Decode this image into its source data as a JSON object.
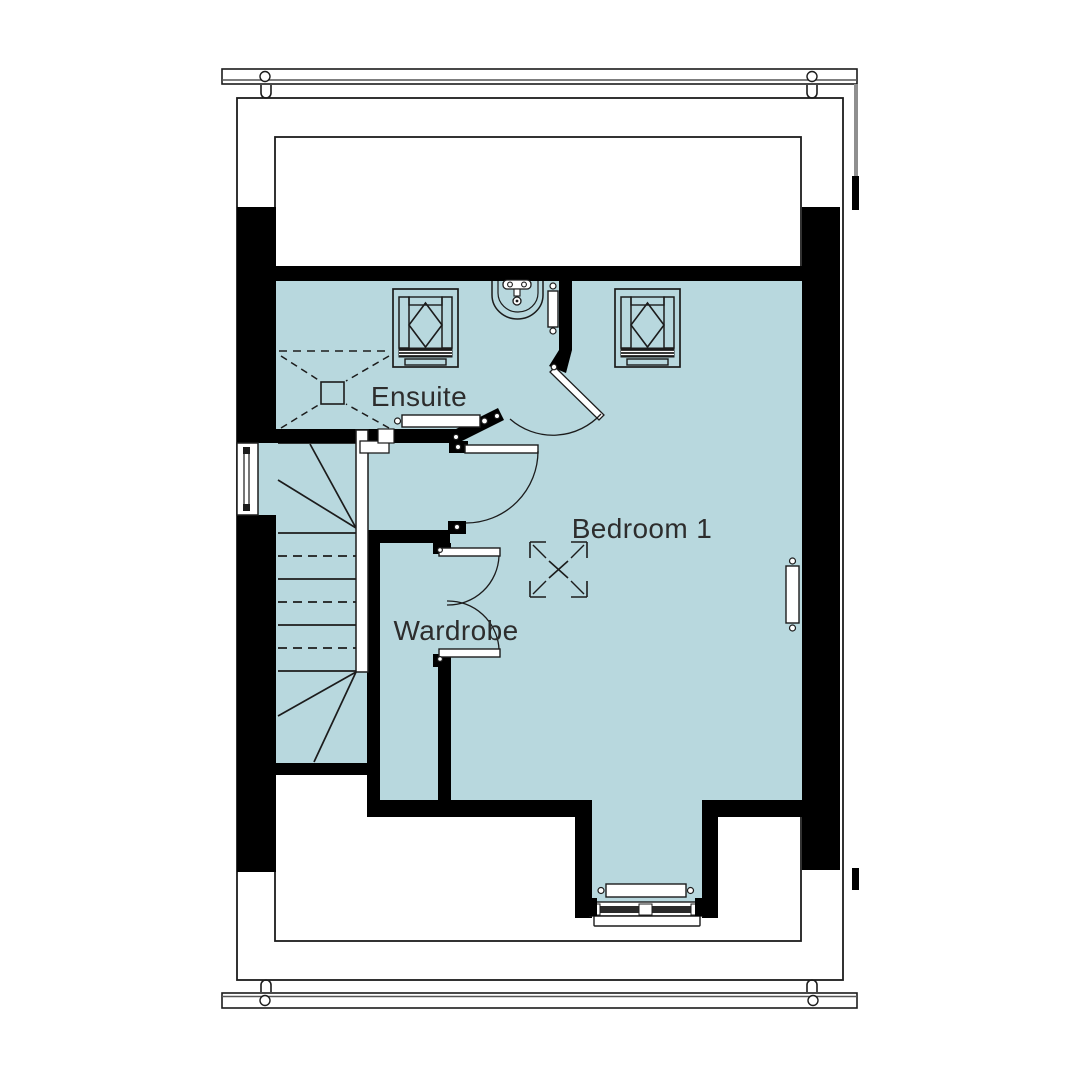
{
  "drawing": {
    "type": "architectural-floor-plan",
    "labels": {
      "ensuite": "Ensuite",
      "bedroom": "Bedroom 1",
      "wardrobe": "Wardrobe"
    },
    "colors": {
      "floor": "#b8d8de",
      "wall": "#000000",
      "line": "#1c1c1c",
      "label_text": "#2d2d2d",
      "gutter_line": "#555555",
      "downpipe": "#8f8f8f"
    },
    "fixtures": [
      "stairs-with-winders",
      "rooflight-ensuite",
      "rooflight-bedroom",
      "wash-basin",
      "shower-extract-symbol",
      "ceiling-hatch-symbol",
      "towel-radiator-ensuite",
      "radiator-ensuite-south",
      "radiator-bedroom-east",
      "radiator-dormer",
      "ensuite-door",
      "bedroom-door",
      "wardrobe-double-doors",
      "side-window",
      "dormer-window",
      "gutter-top",
      "gutter-bottom",
      "downpipe"
    ]
  }
}
